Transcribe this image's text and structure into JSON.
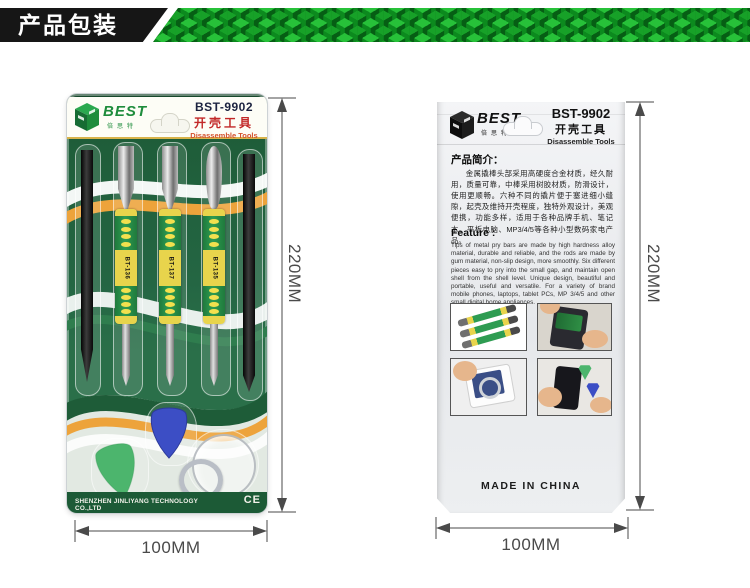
{
  "header": {
    "label": "产品包装"
  },
  "front": {
    "brand": "BEST",
    "brand_cn": "倍思特",
    "model": "BST-9902",
    "title_cn": "开壳工具",
    "title_en": "Disassemble Tools",
    "tool_labels": [
      "BT-136",
      "BT-137",
      "BT-135"
    ],
    "footer_company": "SHENZHEN JINLIYANG TECHNOLOGY CO.,LTD",
    "ce_mark": "CE"
  },
  "back": {
    "brand": "BEST",
    "brand_cn": "倍思特",
    "model": "BST-9902",
    "title_cn": "开壳工具",
    "title_en": "Disassemble Tools",
    "intro_heading": "产品简介：",
    "intro_text": "金属撬棒头部采用高硬度合金材质，经久耐用，质量可靠，中棒采用树胶材质，防滑设计，使用更顺畅。六种不同的撬片便于塞进细小缝隙，起壳及维持开壳程度，独特外观设计，美观便携，功能多样，适用于各种品牌手机、笔记本、平板电脑、MP3/4/5等各种小型数码家电产品。",
    "feature_heading": "Feature :",
    "feature_text": "Tips of metal pry bars are made by high hardness alloy material, durable and reliable, and the rods are made by gum material, non-slip design, more smoothly. Six different pieces easy to pry into the small gap, and maintain open shell from the shell level. Unique design, beautiful and portable, useful and versatile. For a variety of brand mobile phones, laptops, tablet PCs, MP 3/4/5 and other small digital home appliances.",
    "made_in": "MADE IN CHINA"
  },
  "dimensions": {
    "front_height": "220MM",
    "front_width": "100MM",
    "back_height": "220MM",
    "back_width": "100MM"
  },
  "colors": {
    "banner_green_bright": "#27c139",
    "banner_green_dark": "#065e14",
    "card_green": "#1e5c38",
    "wave_orange": "#eda33b",
    "handle_green": "#2e9c52",
    "handle_yellow": "#e8d44c",
    "pick_blue": "#3c4ec5",
    "pick_green": "#4cb56d",
    "title_red": "#c22828",
    "dim_color": "#4a4a4a"
  }
}
